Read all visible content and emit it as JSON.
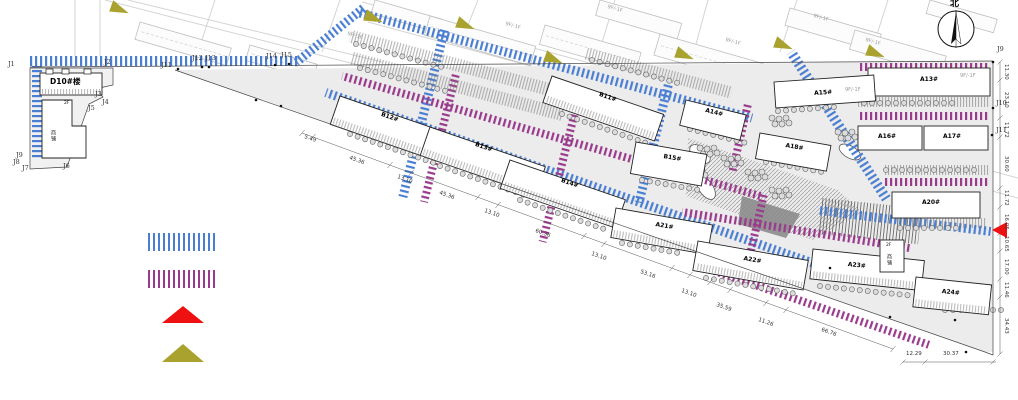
{
  "compass": {
    "north": "北"
  },
  "survey_points": {
    "j1": "J1",
    "j2": "J2",
    "j3": "J3",
    "j4": "J4",
    "j5": "J5",
    "j6": "J6",
    "j7": "J7",
    "j8": "J8",
    "j9_left": "J9",
    "j11_mid": "J11",
    "j12": "J12",
    "j13": "J13",
    "j14": "J14",
    "j15": "J15",
    "j9_right": "J9",
    "j10": "J10",
    "j11_right": "J11"
  },
  "buildings": {
    "d10": "D10#楼",
    "shop_left_floor": "2F",
    "shop_left": "商铺",
    "b11": "B11#",
    "b12": "B12#",
    "b13": "B13#",
    "b14": "B14#",
    "b15": "B15#",
    "a13": "A13#",
    "a14": "A14#",
    "a15": "A15#",
    "a16": "A16#",
    "a17": "A17#",
    "a18": "A18#",
    "a20": "A20#",
    "a21": "A21#",
    "a22": "A22#",
    "a23": "A23#",
    "a24": "A24#",
    "shop_right_floor": "2F",
    "shop_right": "商铺"
  },
  "floor_note": "9F/-1F",
  "dimensions": {
    "south_chain": [
      "5.49",
      "45.36",
      "13.10",
      "45.36",
      "13.10",
      "60.36",
      "13.10",
      "53.16",
      "13.10",
      "35.59",
      "11.26",
      "66.76"
    ],
    "south_corner": [
      "12.29",
      "30.37"
    ],
    "east_chain": [
      "11.30",
      "23.10",
      "11.72",
      "30.60",
      "11.72",
      "16.05",
      "10.65",
      "17.00",
      "11.46",
      "34.43"
    ]
  },
  "legend": {
    "items": [
      {
        "id": "blue-hatch-path",
        "color": "#4a7ed2"
      },
      {
        "id": "purple-hatch-path",
        "color": "#993a8c"
      },
      {
        "id": "red-arrow",
        "color": "#ee1111"
      },
      {
        "id": "yellow-arrow",
        "color": "#aaa22e"
      }
    ]
  }
}
